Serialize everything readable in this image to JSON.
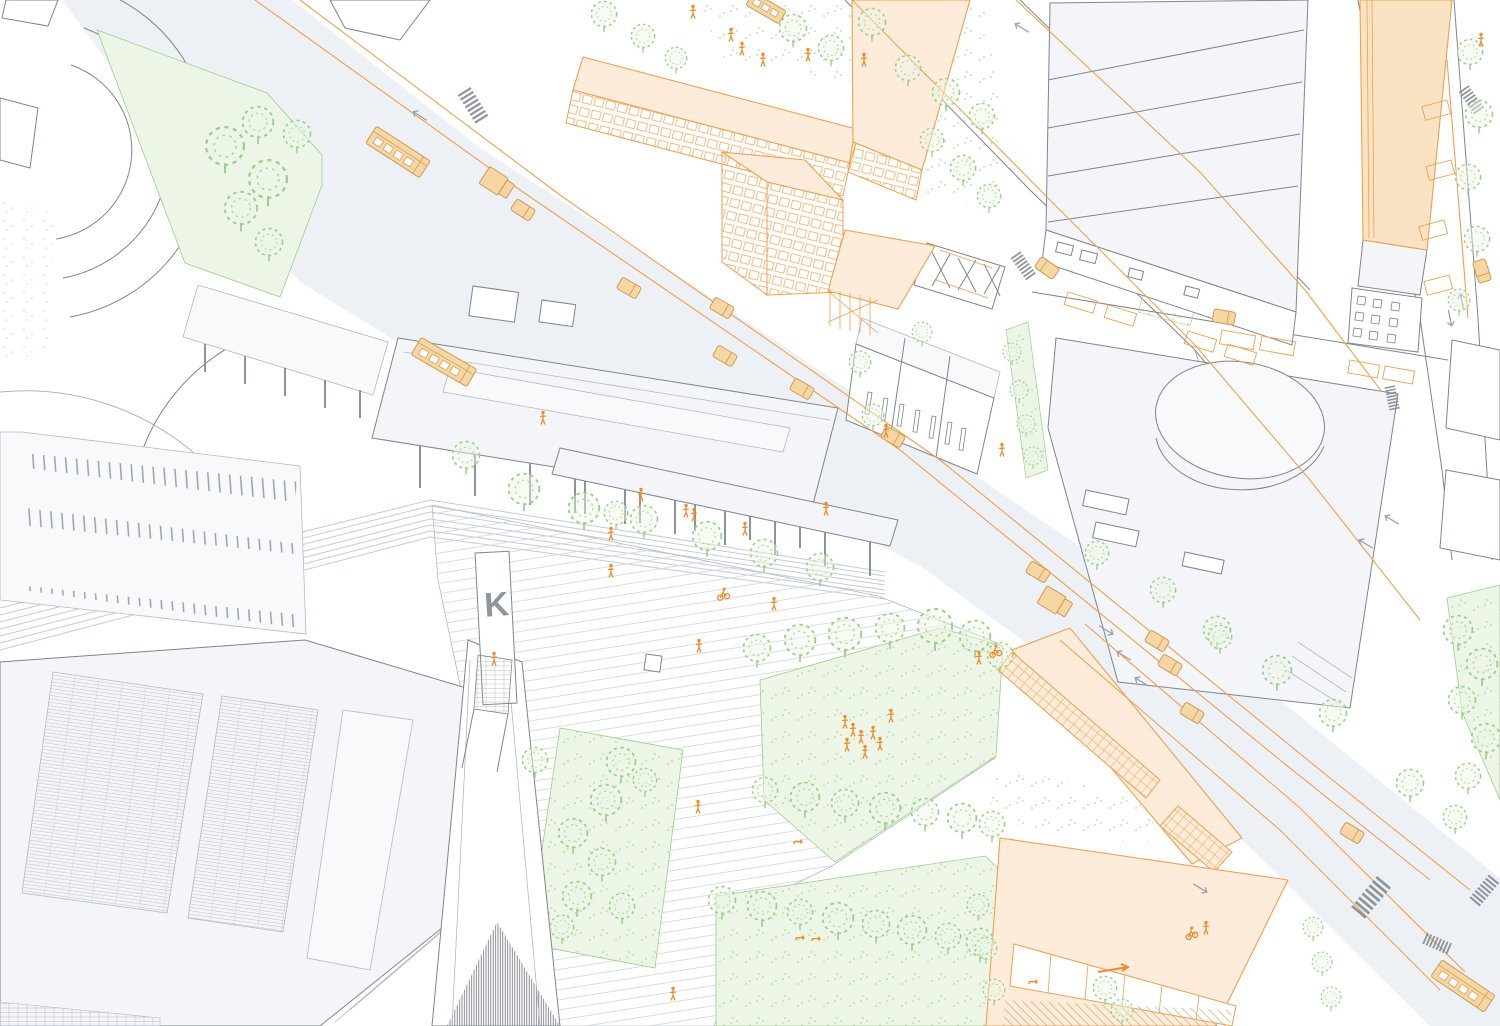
{
  "labels": {
    "pylon": "K"
  },
  "palette": {
    "bg": "#ffffff",
    "road": "#edf1f6",
    "surface": "#f3f5f8",
    "surface2": "#f7f9fb",
    "line": "#7f858e",
    "line_light": "#b4bac2",
    "paving": "#d6dade",
    "track": "#c3ccd6",
    "orange_line": "#f0a050",
    "orange_fill": "#f6d7a4",
    "orange_roof": "#fcecd9",
    "orange_big": "#f9e3c3",
    "orange_deep": "#ef8b2b",
    "vehicle_stroke": "#cf9a55",
    "green_line": "#9ccf8c",
    "green_fill": "#edf6e6",
    "stipple": "#b4d9a4",
    "sand": "#dfd3b8",
    "glass_dark": "#646a73"
  },
  "scene": {
    "trees": [
      [
        225,
        146,
        2.1
      ],
      [
        258,
        122,
        1.7
      ],
      [
        297,
        134,
        1.5
      ],
      [
        268,
        179,
        2.1
      ],
      [
        241,
        208,
        1.8
      ],
      [
        269,
        242,
        1.5
      ],
      [
        466,
        455,
        1.5
      ],
      [
        524,
        489,
        1.7
      ],
      [
        584,
        508,
        1.7
      ],
      [
        616,
        513,
        1.3
      ],
      [
        644,
        519,
        1.5
      ],
      [
        707,
        536,
        1.6
      ],
      [
        764,
        553,
        1.5
      ],
      [
        820,
        567,
        1.5
      ],
      [
        621,
        762,
        1.6
      ],
      [
        645,
        780,
        1.3
      ],
      [
        606,
        800,
        1.7
      ],
      [
        573,
        833,
        1.6
      ],
      [
        602,
        862,
        1.5
      ],
      [
        577,
        896,
        1.6
      ],
      [
        622,
        906,
        1.4
      ],
      [
        562,
        927,
        1.3
      ],
      [
        535,
        760,
        1.4
      ],
      [
        757,
        648,
        1.5
      ],
      [
        800,
        640,
        1.7
      ],
      [
        845,
        634,
        1.8
      ],
      [
        890,
        628,
        1.6
      ],
      [
        935,
        626,
        1.9
      ],
      [
        975,
        636,
        1.7
      ],
      [
        1000,
        655,
        1.4
      ],
      [
        765,
        790,
        1.4
      ],
      [
        805,
        797,
        1.6
      ],
      [
        845,
        803,
        1.5
      ],
      [
        885,
        808,
        1.7
      ],
      [
        925,
        812,
        1.5
      ],
      [
        962,
        818,
        1.6
      ],
      [
        992,
        824,
        1.4
      ],
      [
        722,
        900,
        1.5
      ],
      [
        762,
        906,
        1.6
      ],
      [
        800,
        912,
        1.4
      ],
      [
        838,
        918,
        1.7
      ],
      [
        876,
        924,
        1.5
      ],
      [
        912,
        930,
        1.6
      ],
      [
        948,
        936,
        1.4
      ],
      [
        980,
        942,
        1.5
      ],
      [
        1458,
        630,
        1.6
      ],
      [
        1482,
        664,
        1.7
      ],
      [
        1462,
        700,
        1.5
      ],
      [
        1486,
        738,
        1.6
      ],
      [
        1468,
        776,
        1.4
      ],
      [
        1470,
        52,
        1.4
      ],
      [
        1479,
        114,
        1.5
      ],
      [
        1468,
        177,
        1.4
      ],
      [
        1477,
        239,
        1.4
      ],
      [
        1459,
        300,
        1.2
      ],
      [
        1217,
        630,
        1.5
      ],
      [
        1277,
        670,
        1.6
      ],
      [
        1333,
        713,
        1.5
      ],
      [
        1410,
        783,
        1.5
      ],
      [
        1455,
        817,
        1.3
      ],
      [
        1097,
        553,
        1.3
      ],
      [
        1163,
        590,
        1.4
      ],
      [
        1220,
        637,
        1.3
      ],
      [
        793,
        28,
        1.5
      ],
      [
        831,
        48,
        1.4
      ],
      [
        872,
        22,
        1.5
      ],
      [
        908,
        68,
        1.4
      ],
      [
        946,
        92,
        1.5
      ],
      [
        982,
        116,
        1.4
      ],
      [
        932,
        140,
        1.3
      ],
      [
        963,
        168,
        1.4
      ],
      [
        989,
        196,
        1.3
      ],
      [
        604,
        14,
        1.4
      ],
      [
        643,
        36,
        1.3
      ],
      [
        676,
        58,
        1.2
      ],
      [
        1012,
        352,
        1.0
      ],
      [
        1019,
        390,
        1.0
      ],
      [
        1026,
        424,
        1.0
      ],
      [
        1033,
        456,
        1.0
      ],
      [
        978,
        905,
        1.2
      ],
      [
        986,
        948,
        1.2
      ],
      [
        994,
        990,
        1.2
      ],
      [
        1105,
        988,
        1.3
      ],
      [
        1122,
        1010,
        1.2
      ],
      [
        1313,
        927,
        1.1
      ],
      [
        1322,
        962,
        1.1
      ],
      [
        1331,
        997,
        1.1
      ],
      [
        860,
        362,
        1.2
      ],
      [
        922,
        332,
        1.1
      ],
      [
        873,
        415,
        1.2
      ]
    ],
    "people": [
      [
        693,
        12
      ],
      [
        731,
        35
      ],
      [
        742,
        49
      ],
      [
        763,
        60
      ],
      [
        808,
        55
      ],
      [
        864,
        60
      ],
      [
        543,
        418
      ],
      [
        641,
        495
      ],
      [
        686,
        511
      ],
      [
        694,
        515
      ],
      [
        745,
        529
      ],
      [
        826,
        509
      ],
      [
        611,
        534
      ],
      [
        611,
        571
      ],
      [
        774,
        604
      ],
      [
        699,
        646
      ],
      [
        698,
        807
      ],
      [
        673,
        994
      ],
      [
        494,
        659
      ],
      [
        845,
        722
      ],
      [
        853,
        730
      ],
      [
        861,
        737
      ],
      [
        847,
        745
      ],
      [
        865,
        752
      ],
      [
        873,
        733
      ],
      [
        880,
        744
      ],
      [
        891,
        716
      ],
      [
        1002,
        450
      ],
      [
        979,
        658
      ],
      [
        1206,
        928
      ],
      [
        886,
        431
      ],
      [
        1481,
        40
      ]
    ],
    "cyclists": [
      [
        723,
        594,
        -12
      ],
      [
        995,
        651,
        -15
      ],
      [
        1191,
        933,
        -18
      ]
    ],
    "dogs": [
      [
        799,
        938
      ],
      [
        815,
        939
      ],
      [
        797,
        842
      ],
      [
        1032,
        982
      ]
    ],
    "vehicles": [
      [
        "tram",
        398,
        152,
        33
      ],
      [
        "truck",
        497,
        183,
        33
      ],
      [
        "car",
        523,
        210,
        33
      ],
      [
        "tram",
        444,
        362,
        30
      ],
      [
        "bus",
        766,
        8,
        30
      ],
      [
        "car",
        629,
        288,
        30
      ],
      [
        "car",
        722,
        308,
        30
      ],
      [
        "car",
        725,
        356,
        30
      ],
      [
        "car",
        802,
        389,
        30
      ],
      [
        "car",
        893,
        437,
        30
      ],
      [
        "car",
        1038,
        572,
        31
      ],
      [
        "truck",
        1055,
        602,
        31
      ],
      [
        "car",
        1157,
        641,
        31
      ],
      [
        "car",
        1170,
        665,
        31
      ],
      [
        "car",
        1192,
        713,
        31
      ],
      [
        "car",
        1352,
        833,
        31
      ],
      [
        "car",
        1047,
        268,
        215
      ],
      [
        "car",
        1224,
        317,
        10
      ],
      [
        "car",
        1482,
        271,
        72
      ],
      [
        "tram",
        1463,
        986,
        34
      ]
    ],
    "crosswalks": [
      [
        471,
        88,
        58,
        1
      ],
      [
        1021,
        252,
        55,
        0.8
      ],
      [
        1469,
        86,
        55,
        0.8
      ],
      [
        1395,
        386,
        78,
        0.7
      ],
      [
        1352,
        906,
        -50,
        1.2
      ],
      [
        1470,
        897,
        -50,
        0.9
      ],
      [
        1428,
        933,
        24,
        0.8
      ]
    ],
    "arrows": [
      [
        1106,
        630,
        31
      ],
      [
        1124,
        656,
        211
      ],
      [
        1142,
        682,
        211
      ],
      [
        1392,
        520,
        211
      ],
      [
        1366,
        544,
        211
      ],
      [
        1462,
        302,
        258
      ],
      [
        1450,
        318,
        78
      ],
      [
        1200,
        888,
        31
      ],
      [
        420,
        116,
        213
      ],
      [
        1022,
        28,
        212
      ]
    ]
  }
}
